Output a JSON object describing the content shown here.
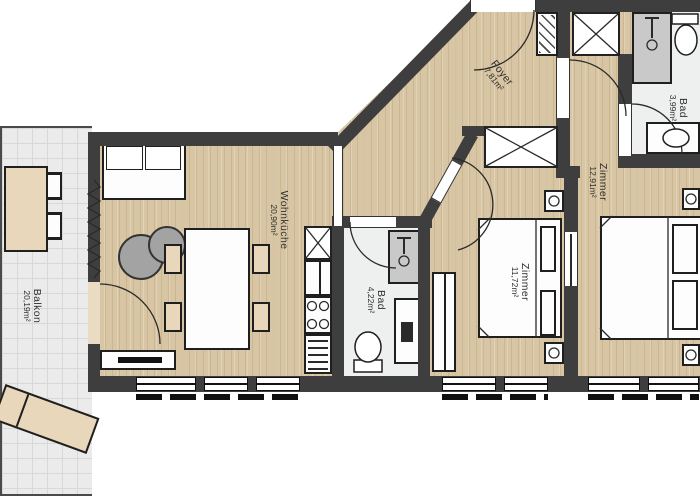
{
  "plan": {
    "title": "apartment-floor-plan",
    "rooms": [
      {
        "id": "balkon",
        "name": "Balkon",
        "area": "20,19m²"
      },
      {
        "id": "wohnkueche",
        "name": "Wohnküche",
        "area": "20,90m²"
      },
      {
        "id": "foyer",
        "name": "Foyer",
        "area": "7,81m²"
      },
      {
        "id": "bad1",
        "name": "Bad",
        "area": "4,22m²"
      },
      {
        "id": "zimmer1",
        "name": "Zimmer",
        "area": "11,72m²"
      },
      {
        "id": "zimmer2",
        "name": "Zimmer",
        "area": "12,91m²"
      },
      {
        "id": "bad2",
        "name": "Bad",
        "area": "3,99m²"
      }
    ],
    "colors": {
      "wall": "#3e3e3e",
      "wood": "#d8c5a3",
      "tile": "#ebebeb",
      "bath": "#eef0ef",
      "beige": "#e8d7bb"
    }
  }
}
